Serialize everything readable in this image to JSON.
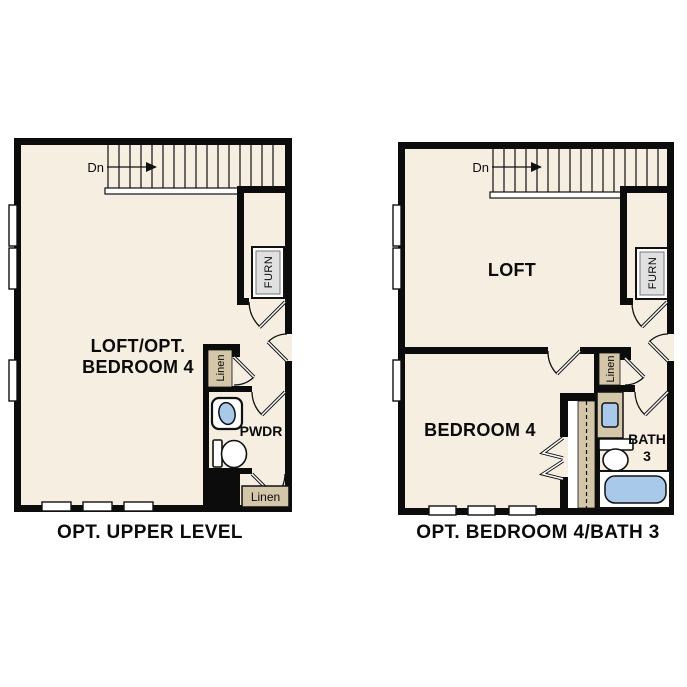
{
  "colors": {
    "floor": "#f6eee1",
    "wall": "#0c0c0c",
    "line": "#111111",
    "tan": "#d4c6a8",
    "blue": "#a9c9ea",
    "gray": "#e0e0e0",
    "white": "#ffffff"
  },
  "plan_left": {
    "title": "OPT. UPPER LEVEL",
    "stairs": {
      "direction_label": "Dn"
    },
    "rooms": {
      "main_line1": "LOFT/OPT.",
      "main_line2": "BEDROOM 4",
      "powder": "PWDR"
    },
    "closets": {
      "furnace": "FURN",
      "linen_upper": "Linen",
      "linen_lower": "Linen"
    }
  },
  "plan_right": {
    "title": "OPT. BEDROOM 4/BATH 3",
    "stairs": {
      "direction_label": "Dn"
    },
    "rooms": {
      "loft": "LOFT",
      "bedroom": "BEDROOM 4",
      "bath_line1": "BATH",
      "bath_line2": "3"
    },
    "closets": {
      "furnace": "FURN",
      "linen": "Linen"
    }
  }
}
